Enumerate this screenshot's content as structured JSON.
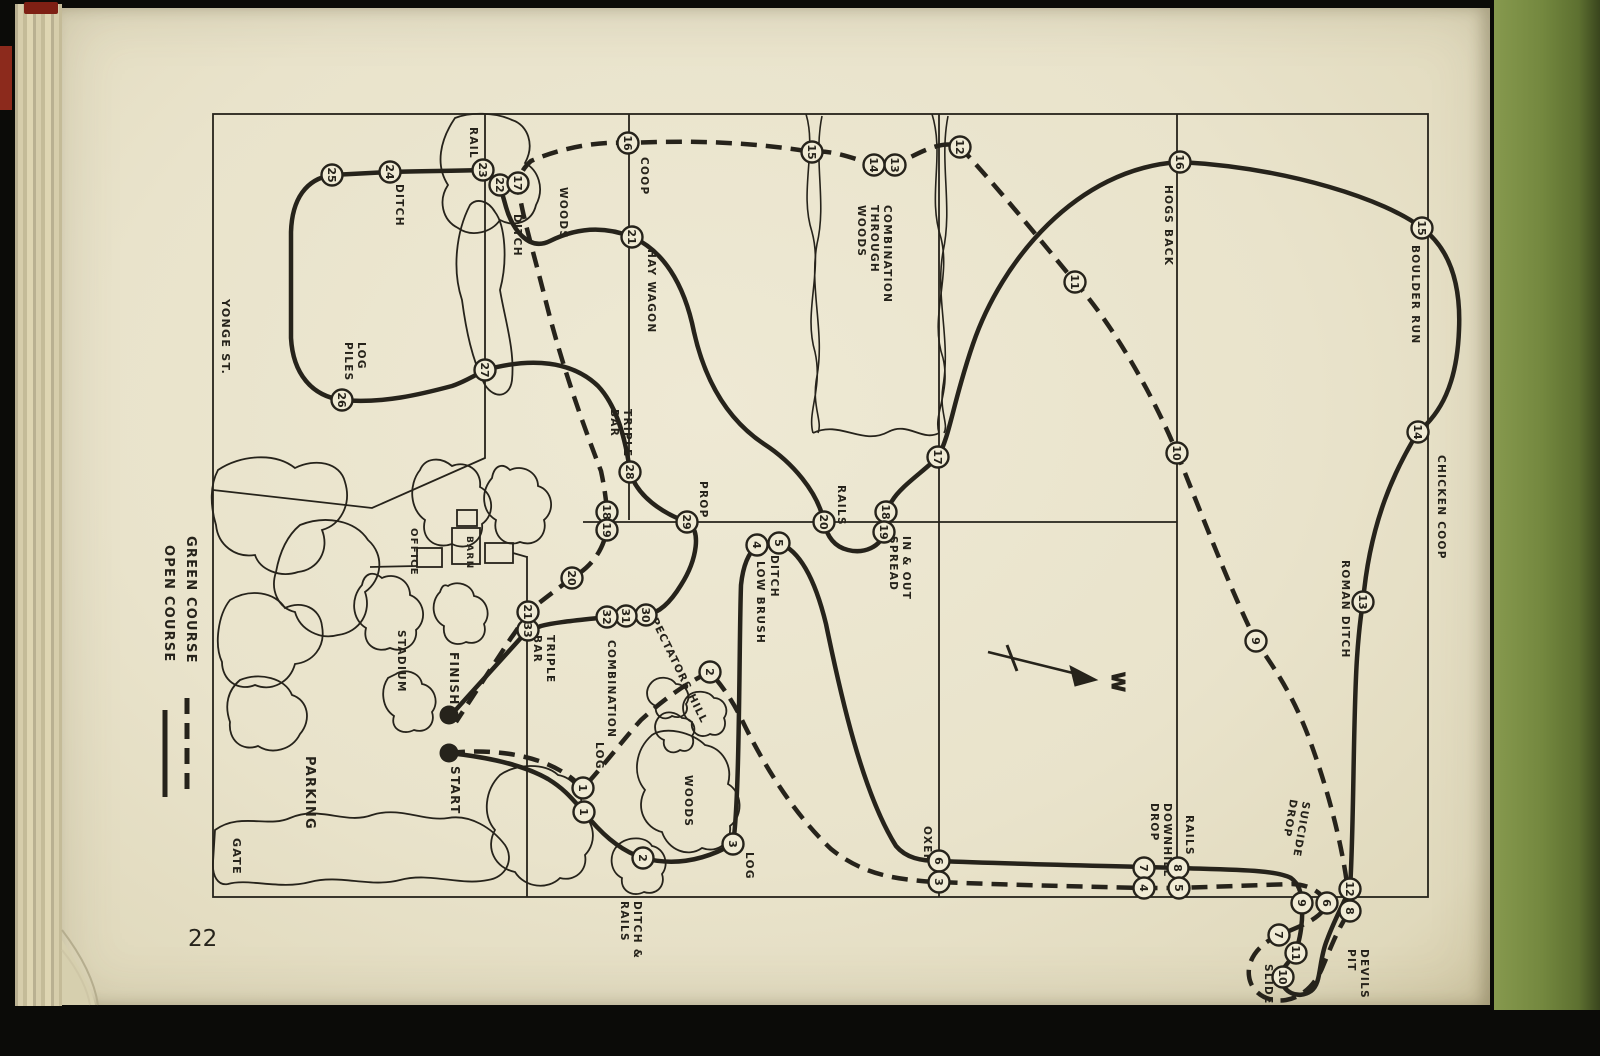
{
  "page": {
    "number": "22"
  },
  "legend": {
    "green": {
      "label": "GREEN COURSE",
      "style": "dashed"
    },
    "open": {
      "label": "OPEN COURSE",
      "style": "solid"
    }
  },
  "compass": {
    "label": "W"
  },
  "markers": {
    "start": {
      "label": "START",
      "x": 449,
      "y": 753
    },
    "finish": {
      "label": "FINISH",
      "x": 449,
      "y": 715
    }
  },
  "colors": {
    "page": "#e9e3cb",
    "ink": "#26231b",
    "cover_green": "#74883f",
    "frame_black": "#0b0b08",
    "red_mark": "#8c2a1c"
  },
  "stations": {
    "open": [
      {
        "n": "1",
        "x": 584,
        "y": 812
      },
      {
        "n": "2",
        "x": 643,
        "y": 858
      },
      {
        "n": "3",
        "x": 733,
        "y": 844
      },
      {
        "n": "4",
        "x": 757,
        "y": 545
      },
      {
        "n": "5",
        "x": 779,
        "y": 543
      },
      {
        "n": "6",
        "x": 939,
        "y": 861
      },
      {
        "n": "7",
        "x": 1144,
        "y": 868
      },
      {
        "n": "8",
        "x": 1178,
        "y": 868
      },
      {
        "n": "9",
        "x": 1302,
        "y": 903
      },
      {
        "n": "10",
        "x": 1283,
        "y": 977
      },
      {
        "n": "11",
        "x": 1296,
        "y": 953
      },
      {
        "n": "12",
        "x": 1350,
        "y": 889
      },
      {
        "n": "13",
        "x": 1363,
        "y": 602
      },
      {
        "n": "14",
        "x": 1418,
        "y": 432
      },
      {
        "n": "15",
        "x": 1422,
        "y": 228
      },
      {
        "n": "16",
        "x": 1180,
        "y": 162
      },
      {
        "n": "17",
        "x": 938,
        "y": 457
      },
      {
        "n": "18",
        "x": 886,
        "y": 512
      },
      {
        "n": "19",
        "x": 884,
        "y": 532
      },
      {
        "n": "20",
        "x": 824,
        "y": 522
      },
      {
        "n": "21",
        "x": 632,
        "y": 237
      },
      {
        "n": "22",
        "x": 500,
        "y": 185
      },
      {
        "n": "23",
        "x": 483,
        "y": 170
      },
      {
        "n": "24",
        "x": 390,
        "y": 172
      },
      {
        "n": "25",
        "x": 332,
        "y": 175
      },
      {
        "n": "26",
        "x": 342,
        "y": 400
      },
      {
        "n": "27",
        "x": 485,
        "y": 370
      },
      {
        "n": "28",
        "x": 630,
        "y": 472
      },
      {
        "n": "29",
        "x": 687,
        "y": 522
      },
      {
        "n": "30",
        "x": 646,
        "y": 615
      },
      {
        "n": "31",
        "x": 626,
        "y": 616
      },
      {
        "n": "32",
        "x": 607,
        "y": 617
      },
      {
        "n": "33",
        "x": 528,
        "y": 630
      }
    ],
    "green": [
      {
        "n": "1",
        "x": 583,
        "y": 788
      },
      {
        "n": "2",
        "x": 710,
        "y": 672
      },
      {
        "n": "3",
        "x": 939,
        "y": 882
      },
      {
        "n": "4",
        "x": 1144,
        "y": 888
      },
      {
        "n": "5",
        "x": 1179,
        "y": 888
      },
      {
        "n": "6",
        "x": 1327,
        "y": 903
      },
      {
        "n": "7",
        "x": 1279,
        "y": 935
      },
      {
        "n": "8",
        "x": 1350,
        "y": 911
      },
      {
        "n": "9",
        "x": 1256,
        "y": 641
      },
      {
        "n": "10",
        "x": 1177,
        "y": 453
      },
      {
        "n": "11",
        "x": 1075,
        "y": 282
      },
      {
        "n": "12",
        "x": 960,
        "y": 147
      },
      {
        "n": "13",
        "x": 895,
        "y": 165
      },
      {
        "n": "14",
        "x": 874,
        "y": 165
      },
      {
        "n": "15",
        "x": 812,
        "y": 152
      },
      {
        "n": "16",
        "x": 628,
        "y": 143
      },
      {
        "n": "17",
        "x": 518,
        "y": 183
      },
      {
        "n": "18",
        "x": 607,
        "y": 512
      },
      {
        "n": "19",
        "x": 607,
        "y": 530
      },
      {
        "n": "20",
        "x": 572,
        "y": 578
      },
      {
        "n": "21",
        "x": 528,
        "y": 612
      }
    ]
  },
  "labels": [
    {
      "lines": [
        "RAIL"
      ],
      "x": 470,
      "y": 127,
      "rot": 90,
      "size": 10.5
    },
    {
      "lines": [
        "WOODS"
      ],
      "x": 560,
      "y": 187,
      "rot": 90,
      "size": 10.5
    },
    {
      "lines": [
        "COOP"
      ],
      "x": 641,
      "y": 157,
      "rot": 90,
      "size": 10.5
    },
    {
      "lines": [
        "DITCH"
      ],
      "x": 514,
      "y": 214,
      "rot": 90,
      "size": 10.5
    },
    {
      "lines": [
        "DITCH"
      ],
      "x": 396,
      "y": 184,
      "rot": 90,
      "size": 10.5
    },
    {
      "lines": [
        "HAY WAGON"
      ],
      "x": 648,
      "y": 249,
      "rot": 90,
      "size": 10.5
    },
    {
      "lines": [
        "COMBINATION",
        "THROUGH",
        "WOODS"
      ],
      "x": 884,
      "y": 205,
      "rot": 90,
      "size": 10.5
    },
    {
      "lines": [
        "HOGS BACK"
      ],
      "x": 1165,
      "y": 185,
      "rot": 90,
      "size": 10.5
    },
    {
      "lines": [
        "BOULDER RUN"
      ],
      "x": 1412,
      "y": 245,
      "rot": 90,
      "size": 10.5
    },
    {
      "lines": [
        "CHICKEN COOP"
      ],
      "x": 1438,
      "y": 455,
      "rot": 90,
      "size": 10.5
    },
    {
      "lines": [
        "ROMAN DITCH"
      ],
      "x": 1342,
      "y": 560,
      "rot": 90,
      "size": 10.5
    },
    {
      "lines": [
        "YONGE ST."
      ],
      "x": 222,
      "y": 299,
      "rot": 90,
      "size": 11
    },
    {
      "lines": [
        "LOG",
        "PILES"
      ],
      "x": 358,
      "y": 342,
      "rot": 90,
      "size": 10.5
    },
    {
      "lines": [
        "TRIPLE",
        "BAR"
      ],
      "x": 624,
      "y": 409,
      "rot": 90,
      "size": 10.5
    },
    {
      "lines": [
        "PROP"
      ],
      "x": 700,
      "y": 481,
      "rot": 90,
      "size": 10.5
    },
    {
      "lines": [
        "RAILS"
      ],
      "x": 838,
      "y": 485,
      "rot": 90,
      "size": 10.5
    },
    {
      "lines": [
        "IN & OUT",
        "SPREAD"
      ],
      "x": 903,
      "y": 536,
      "rot": 90,
      "size": 10.5
    },
    {
      "lines": [
        "DITCH"
      ],
      "x": 771,
      "y": 555,
      "rot": 90,
      "size": 10.5
    },
    {
      "lines": [
        "LOW BRUSH"
      ],
      "x": 757,
      "y": 561,
      "rot": 90,
      "size": 10.5
    },
    {
      "lines": [
        "OFFICE"
      ],
      "x": 411,
      "y": 528,
      "rot": 90,
      "size": 10
    },
    {
      "lines": [
        "BARN"
      ],
      "x": 467,
      "y": 536,
      "rot": 90,
      "size": 9
    },
    {
      "lines": [
        "STADIUM"
      ],
      "x": 398,
      "y": 630,
      "rot": 90,
      "size": 10.5
    },
    {
      "lines": [
        "FINISH"
      ],
      "x": 450,
      "y": 652,
      "rot": 90,
      "size": 12
    },
    {
      "lines": [
        "START"
      ],
      "x": 451,
      "y": 766,
      "rot": 90,
      "size": 12
    },
    {
      "lines": [
        "GATE"
      ],
      "x": 233,
      "y": 838,
      "rot": 90,
      "size": 11
    },
    {
      "lines": [
        "PARKING"
      ],
      "x": 306,
      "y": 756,
      "rot": 90,
      "size": 13
    },
    {
      "lines": [
        "LOG"
      ],
      "x": 596,
      "y": 742,
      "rot": 90,
      "size": 10.5
    },
    {
      "lines": [
        "TRIPLE",
        "BAR"
      ],
      "x": 547,
      "y": 635,
      "rot": 90,
      "size": 10.5
    },
    {
      "lines": [
        "COMBINATION"
      ],
      "x": 608,
      "y": 640,
      "rot": 90,
      "size": 10.5
    },
    {
      "lines": [
        "SPECTATORS HILL"
      ],
      "x": 647,
      "y": 612,
      "rot": 64,
      "size": 10.5
    },
    {
      "lines": [
        "WOODS"
      ],
      "x": 685,
      "y": 775,
      "rot": 90,
      "size": 10.5
    },
    {
      "lines": [
        "LOG"
      ],
      "x": 746,
      "y": 852,
      "rot": 90,
      "size": 10.5
    },
    {
      "lines": [
        "DITCH &",
        "RAILS"
      ],
      "x": 634,
      "y": 901,
      "rot": 90,
      "size": 10.5
    },
    {
      "lines": [
        "OXER"
      ],
      "x": 924,
      "y": 826,
      "rot": 90,
      "size": 10.5
    },
    {
      "lines": [
        "DOWNHILL",
        "DROP"
      ],
      "x": 1164,
      "y": 803,
      "rot": 90,
      "size": 10.5
    },
    {
      "lines": [
        "RAILS"
      ],
      "x": 1186,
      "y": 815,
      "rot": 90,
      "size": 10.5
    },
    {
      "lines": [
        "SUICIDE",
        "DROP"
      ],
      "x": 1303,
      "y": 801,
      "rot": 100,
      "size": 10.5
    },
    {
      "lines": [
        "DEVILS",
        "PIT"
      ],
      "x": 1361,
      "y": 949,
      "rot": 90,
      "size": 10.5
    },
    {
      "lines": [
        "SLIDE"
      ],
      "x": 1265,
      "y": 964,
      "rot": 90,
      "size": 10.5
    }
  ]
}
